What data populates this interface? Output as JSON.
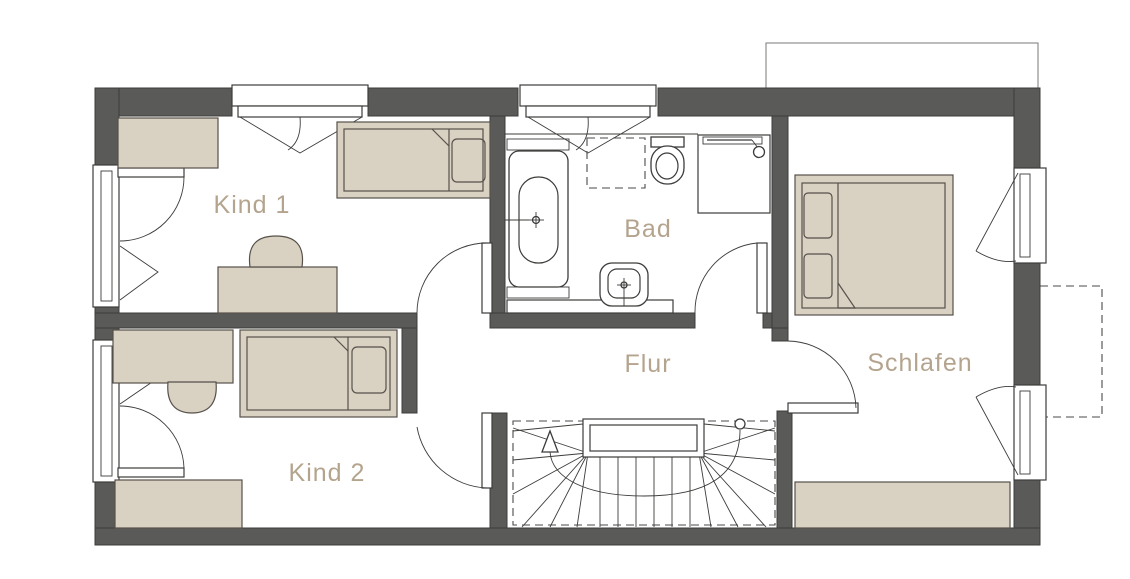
{
  "plan": {
    "kind": "floor-plan",
    "level": "upper-floor"
  },
  "rooms": {
    "kind1": {
      "label": "Kind 1"
    },
    "kind2": {
      "label": "Kind 2"
    },
    "bad": {
      "label": "Bad"
    },
    "flur": {
      "label": "Flur"
    },
    "schlafen": {
      "label": "Schlafen"
    }
  },
  "colors": {
    "wall": "#5a5a58",
    "line": "#3c3c3a",
    "dashed": "#4a4a48",
    "furniture": "#d9d1c2",
    "furniture_outline": "#56514b",
    "label": "#b4a48e",
    "background": "#ffffff"
  },
  "furniture_icons": [
    "wardrobe",
    "single-bed",
    "double-bed",
    "pillow",
    "desk",
    "chair",
    "bathtub",
    "shower",
    "shower-rail",
    "toilet",
    "washbasin",
    "vanity-counter",
    "staircase",
    "walk-line",
    "door-swing",
    "window",
    "balcony-outline",
    "dormer-outline"
  ]
}
